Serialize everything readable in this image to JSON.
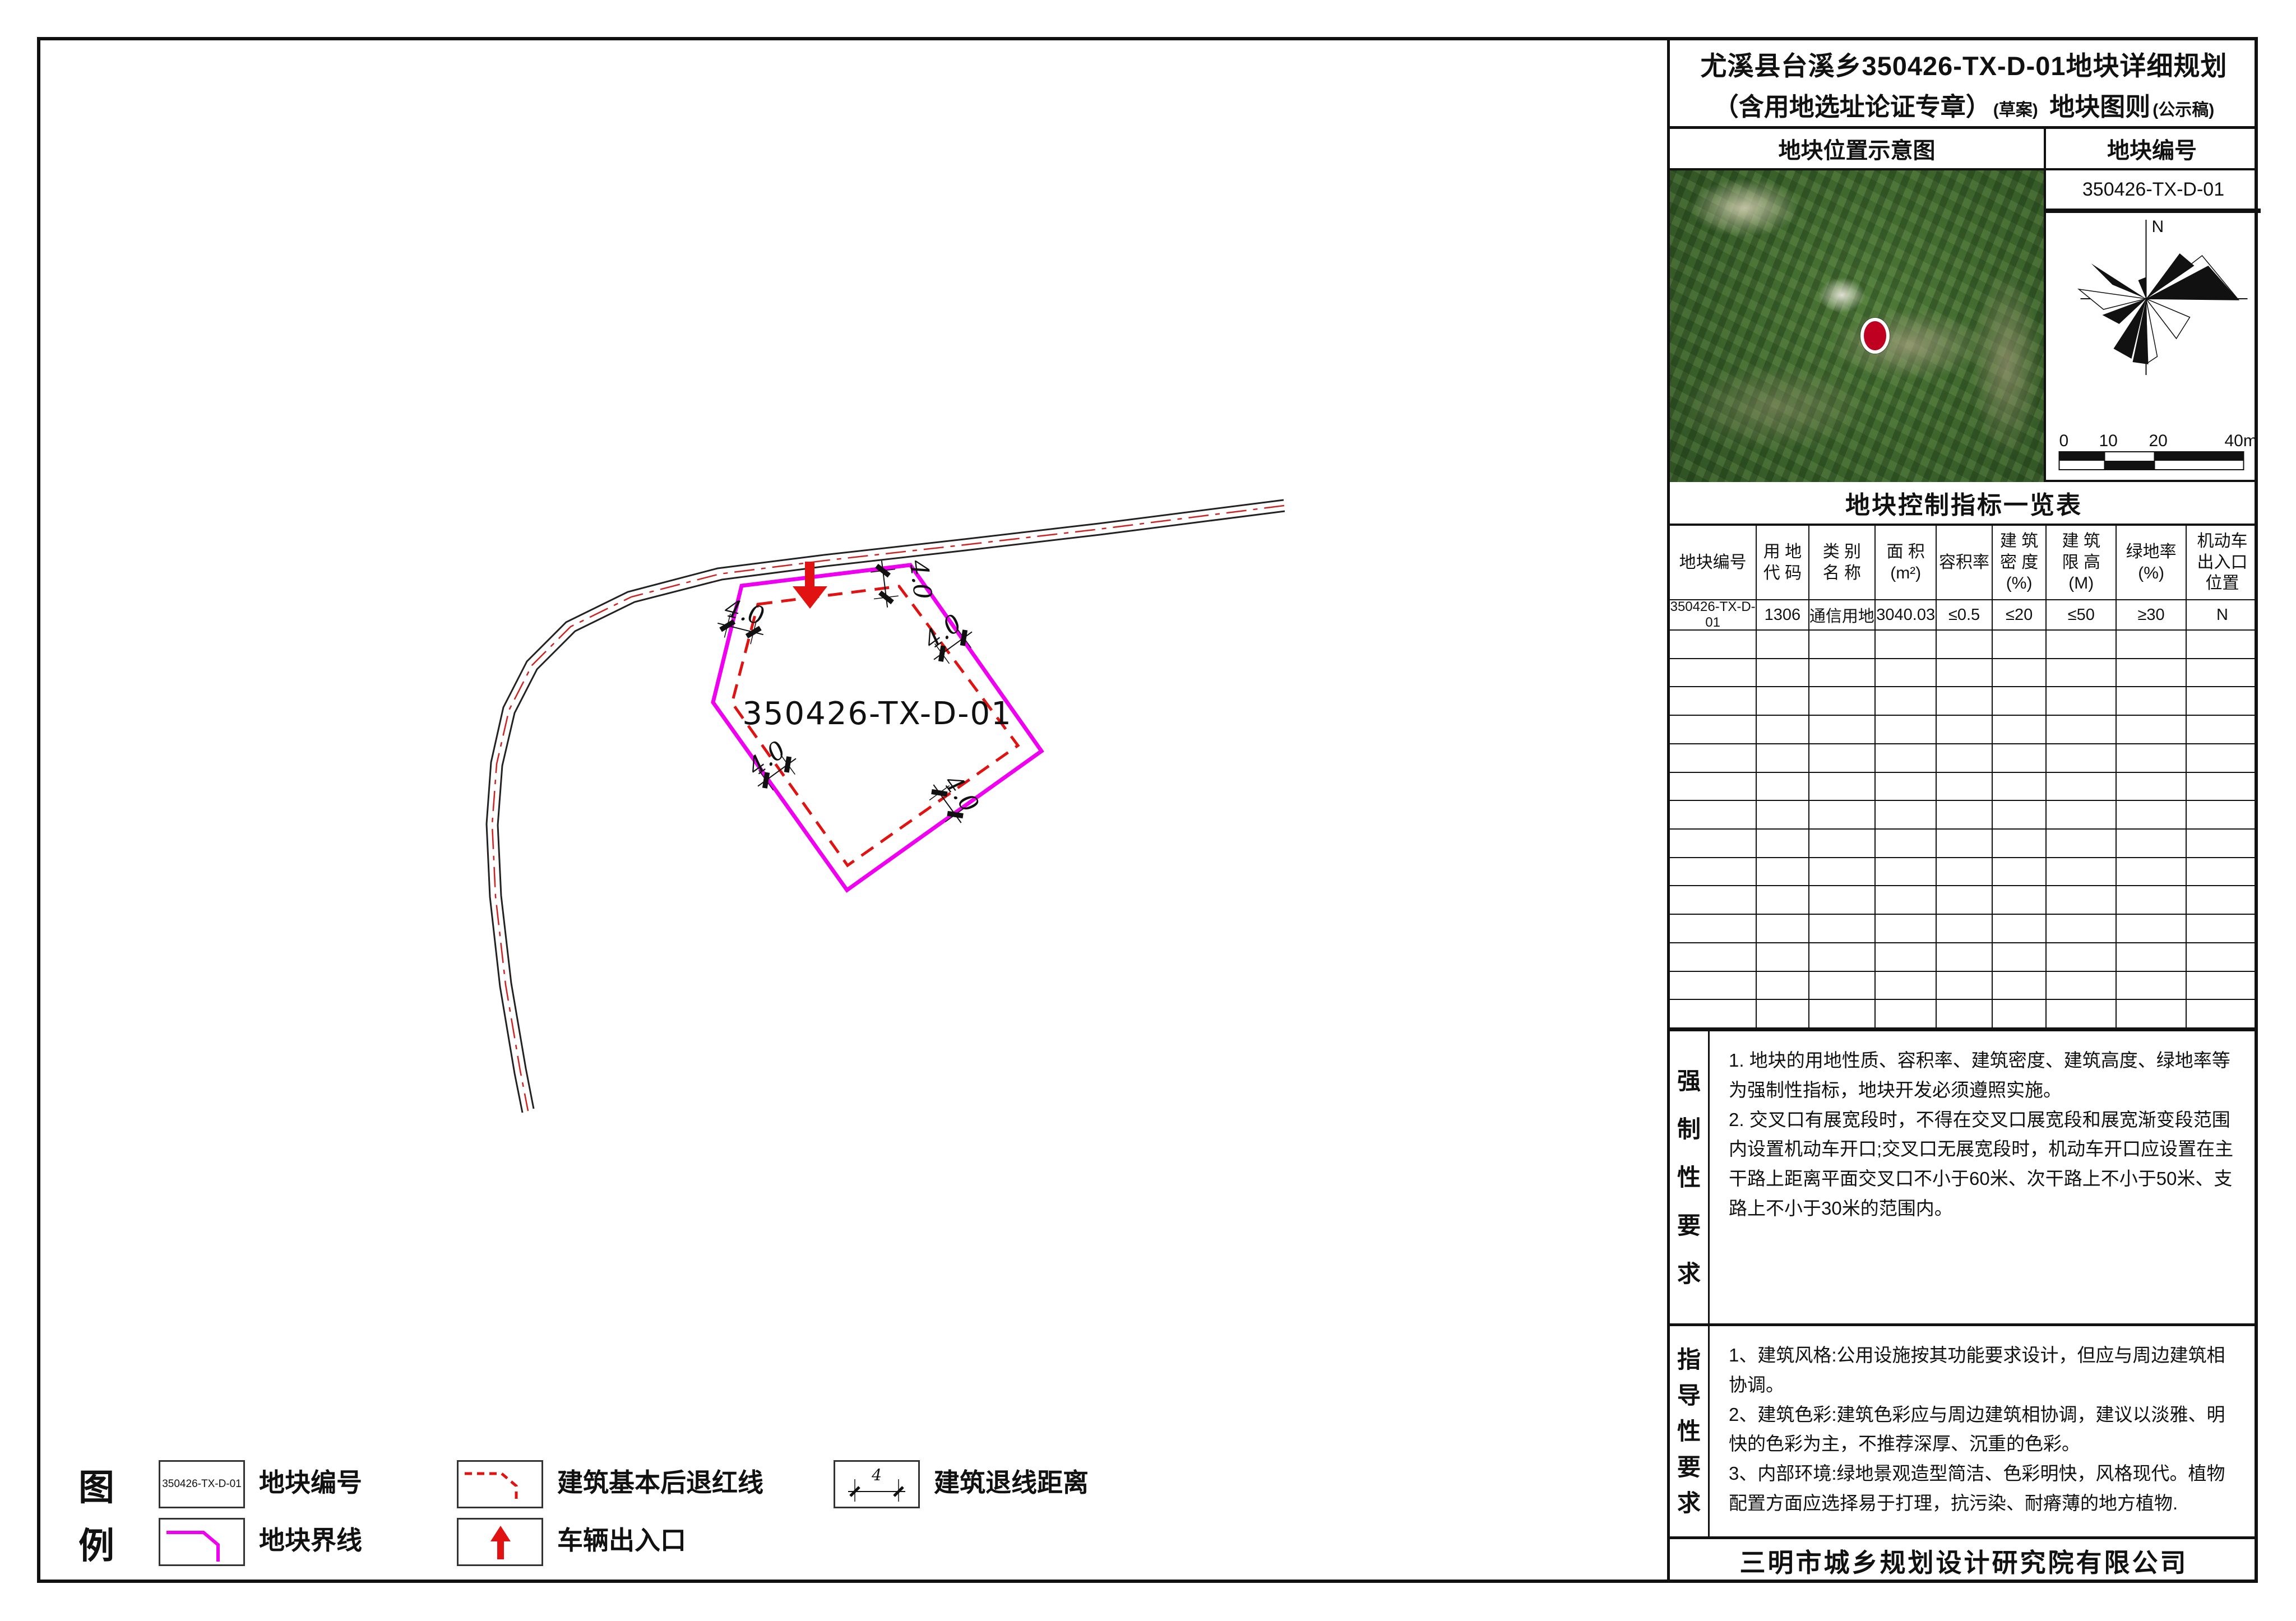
{
  "title": {
    "line1": "尤溪县台溪乡350426-TX-D-01地块详细规划",
    "line2_a": "（含用地选址论证专章）",
    "line2_b": "(草案)",
    "line2_c": "地块图则",
    "line2_d": "(公示稿)"
  },
  "panel": {
    "loc_header": "地块位置示意图",
    "code_header": "地块编号",
    "plot_code": "350426-TX-D-01",
    "table_title": "地块控制指标一览表",
    "compass_n": "N",
    "scale_labels": [
      "0",
      "10",
      "20",
      "40m"
    ]
  },
  "table": {
    "columns": [
      "地块编号",
      "用 地\n代 码",
      "类 别\n名 称",
      "面 积\n(m²)",
      "容积率",
      "建 筑\n密 度\n(%)",
      "建 筑\n限 高\n(M)",
      "绿地率\n(%)",
      "机动车\n出入口\n位置"
    ],
    "row": [
      "350426-TX-D-01",
      "1306",
      "通信用地",
      "3040.03",
      "≤0.5",
      "≤20",
      "≤50",
      "≥30",
      "N"
    ]
  },
  "mandatory": {
    "label": "强\n制\n性\n要\n求",
    "p1": "1. 地块的用地性质、容积率、建筑密度、建筑高度、绿地率等为强制性指标，地块开发必须遵照实施。",
    "p2": "2. 交叉口有展宽段时，不得在交叉口展宽段和展宽渐变段范围内设置机动车开口;交叉口无展宽段时，机动车开口应设置在主干路上距离平面交叉口不小于60米、次干路上不小于50米、支路上不小于30米的范围内。"
  },
  "guidance": {
    "label": "指\n导\n性\n要\n求",
    "p1": "1、建筑风格:公用设施按其功能要求设计，但应与周边建筑相协调。",
    "p2": "2、建筑色彩:建筑色彩应与周边建筑相协调，建议以淡雅、明快的色彩为主，不推荐深厚、沉重的色彩。",
    "p3": "3、内部环境:绿地景观造型简洁、色彩明快，风格现代。植物配置方面应选择易于打理，抗污染、耐瘠薄的地方植物."
  },
  "footer": {
    "company": "三明市城乡规划设计研究院有限公司"
  },
  "map": {
    "plot_label": "350426-TX-D-01",
    "dim_label": "4.0"
  },
  "legend": {
    "title": "图\n例",
    "plot_code": "350426-TX-D-01",
    "items": [
      {
        "label": "地块编号"
      },
      {
        "label": "地块界线"
      },
      {
        "label": "建筑基本后退红线"
      },
      {
        "label": "车辆出入口"
      },
      {
        "label": "建筑退线距离"
      }
    ]
  },
  "colors": {
    "parcel_boundary": "#f000f0",
    "setback_line": "#e01212",
    "road_centerline": "#d02020",
    "marker": "#c00020"
  }
}
